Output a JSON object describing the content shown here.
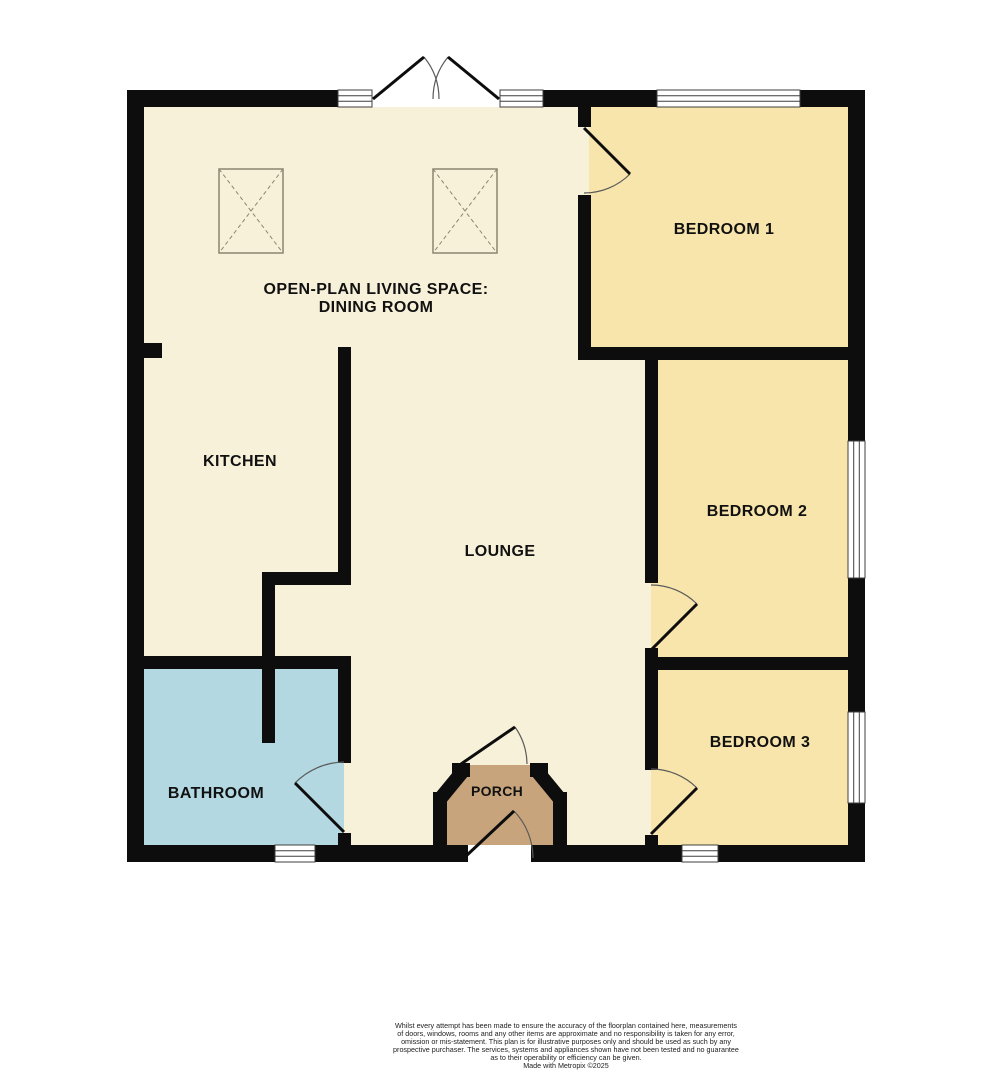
{
  "floorplan": {
    "wall_color": "#0d0d0d",
    "window_frame_color": "#3f3f3f",
    "door_arc_color": "#5a5a5a",
    "skylight_color": "#8a8670",
    "rooms": {
      "living": {
        "label_line1": "OPEN-PLAN LIVING SPACE:",
        "label_line2": "DINING ROOM",
        "color": "#f8f1d9"
      },
      "kitchen": {
        "label": "KITCHEN",
        "color": "#f8f1d9"
      },
      "lounge": {
        "label": "LOUNGE",
        "color": "#f8f1d9"
      },
      "bathroom": {
        "label": "BATHROOM",
        "color": "#b3d8e1"
      },
      "porch": {
        "label": "PORCH",
        "color": "#c8a47d"
      },
      "bedroom1": {
        "label": "BEDROOM 1",
        "color": "#f8e5ab"
      },
      "bedroom2": {
        "label": "BEDROOM 2",
        "color": "#f8e5ab"
      },
      "bedroom3": {
        "label": "BEDROOM 3",
        "color": "#f8e5ab"
      }
    }
  },
  "footer": {
    "disclaimer_lines": [
      "Whilst every attempt has been made to ensure the accuracy of the floorplan contained here, measurements",
      "of doors, windows, rooms and any other items are approximate and no responsibility is taken for any error,",
      "omission or mis-statement. This plan is for illustrative purposes only and should be used as such by any",
      "prospective purchaser. The services, systems and appliances shown have not been tested and no guarantee",
      "as to their operability or efficiency can be given."
    ],
    "credit": "Made with Metropix ©2025"
  }
}
